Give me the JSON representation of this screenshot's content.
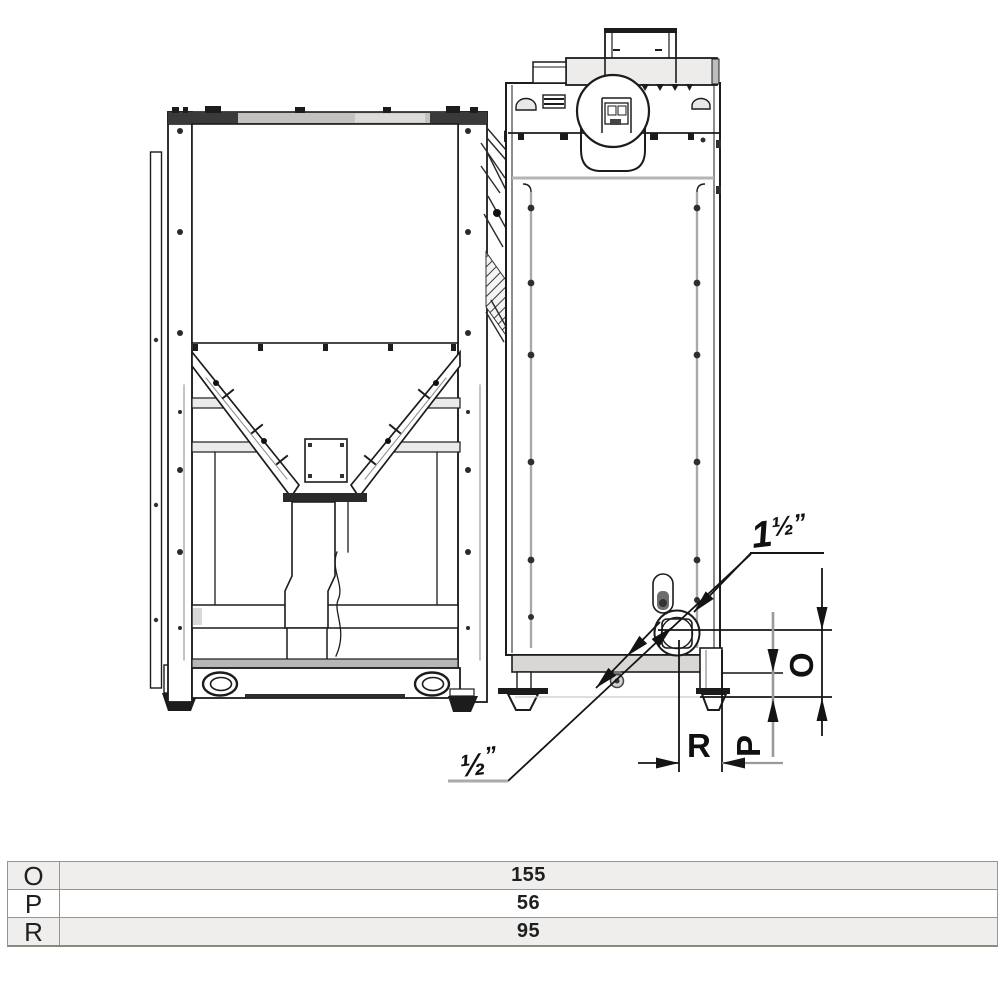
{
  "drawing": {
    "title": "boiler-and-hopper-dimension-drawing",
    "views": {
      "left_view": "pellet-hopper-front-view",
      "right_view": "boiler-side-view"
    },
    "annotations": {
      "large_pipe": {
        "whole": "1",
        "fraction": "½",
        "unit": "”"
      },
      "small_pipe": {
        "fraction": "½",
        "unit": "”"
      },
      "dims": {
        "o": "O",
        "p": "P",
        "r": "R"
      }
    },
    "colors": {
      "line": "#1c1c1c",
      "gray_line": "#a5a5a5",
      "fill_light": "#ececec"
    }
  },
  "table": {
    "rows": [
      {
        "key": "O",
        "value": "155"
      },
      {
        "key": "P",
        "value": "56"
      },
      {
        "key": "R",
        "value": "95"
      }
    ]
  }
}
